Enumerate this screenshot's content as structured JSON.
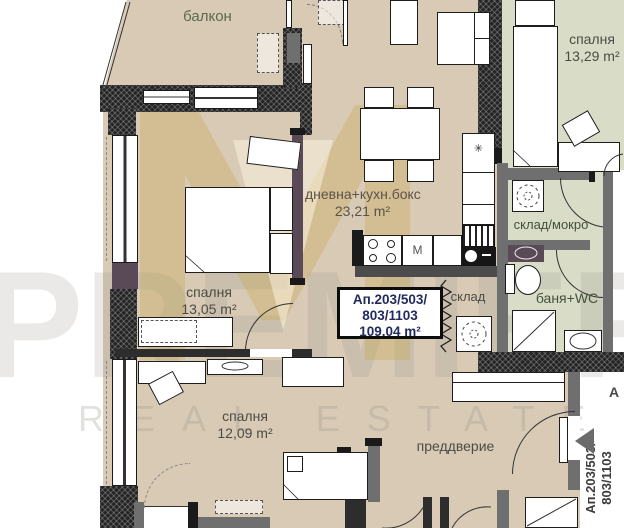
{
  "watermark": {
    "brand": "PREMIER",
    "tagline": "REAL ESTATE"
  },
  "rooms": {
    "balcony": {
      "name": "балкон"
    },
    "bedroom_top": {
      "name": "спалня",
      "area": "13,29 m²"
    },
    "living": {
      "name": "дневна+кухн.бокс",
      "area": "23,21 m²"
    },
    "storage_wet": {
      "name": "склад/мокро"
    },
    "bedroom_left": {
      "name": "спалня",
      "area": "13,05 m²"
    },
    "storage": {
      "name": "склад"
    },
    "bathroom": {
      "name": "баня+WC"
    },
    "bedroom_bottom": {
      "name": "спалня",
      "area": "12,09 m²"
    },
    "hallway": {
      "name": "преддверие"
    }
  },
  "apartment_label": {
    "line1": "Ап.203/503/",
    "line2": "803/1103",
    "line3": "109.04 m²"
  },
  "entrance_label": {
    "line1": "Ап.203/503/",
    "line2": "803/1103",
    "partial_letter": "А"
  },
  "appliances": {
    "m_label": "М",
    "star_label": "✳"
  },
  "colors": {
    "floor_beige": "#d8cab5",
    "floor_green": "#d9dcc7",
    "wall_dark": "#2d2d2d",
    "wall_gray": "#6f6f6f",
    "wall_purple": "#5a4a58",
    "label_navy": "#232b5e",
    "logo_gold": "#c69a33"
  }
}
